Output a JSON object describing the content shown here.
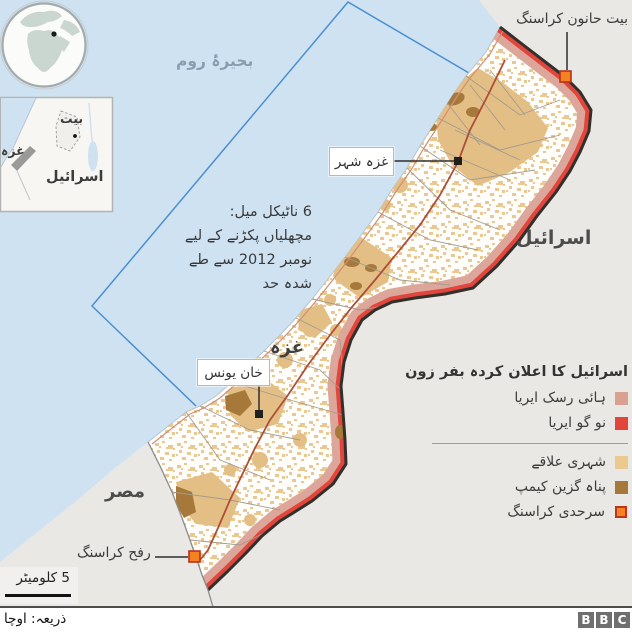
{
  "sea": {
    "label": "بحیرۂ روم"
  },
  "countries": {
    "israel": "اسرائیل",
    "egypt": "مصر",
    "gaza": "غزہ"
  },
  "cities": {
    "gaza_city": "غزہ شہر",
    "khan_younis": "خان یونس"
  },
  "crossings": {
    "beit_hanoun": "بیت حانون کراسنگ",
    "rafah": "رفح کراسنگ"
  },
  "fishing_note": {
    "line1": "6 ناٹیکل میل:",
    "line2": "مچھلیاں پکڑنے کے لیے",
    "line3": "نومبر 2012 سے طے",
    "line4": "شدہ حد"
  },
  "inset": {
    "labels": {
      "bayt": "بیت",
      "gaza": "غزہ",
      "israel": "اسرائیل"
    }
  },
  "legend": {
    "title": "اسرائیل کا اعلان کردہ بفر زون",
    "items": [
      {
        "label": "ہائی رسک ایریا",
        "color": "#d9a190"
      },
      {
        "label": "نو گو ایریا",
        "color": "#e2453c"
      },
      {
        "label": "شہری علاقے",
        "color": "#ecc98f"
      },
      {
        "label": "پناہ گزین کیمپ",
        "color": "#a6793b"
      },
      {
        "label": "سرحدی کراسنگ",
        "color": "#f58220",
        "border": "#c0341f"
      }
    ]
  },
  "scale": {
    "label": "5 کلومیٹر"
  },
  "footer": {
    "source": "ذریعہ: اوچا",
    "logo": [
      "B",
      "B",
      "C"
    ]
  },
  "colors": {
    "sea": "#cfe2f2",
    "land": "#e9e8e5",
    "gaza_fill": "#fffefb",
    "urban": "#e7c289",
    "camp": "#a6793b",
    "no_go": "#e2453c",
    "high_risk": "#dca79a",
    "border_dark": "#33302c",
    "fishing_line": "#4a8fd1",
    "crossing": "#f58220"
  }
}
